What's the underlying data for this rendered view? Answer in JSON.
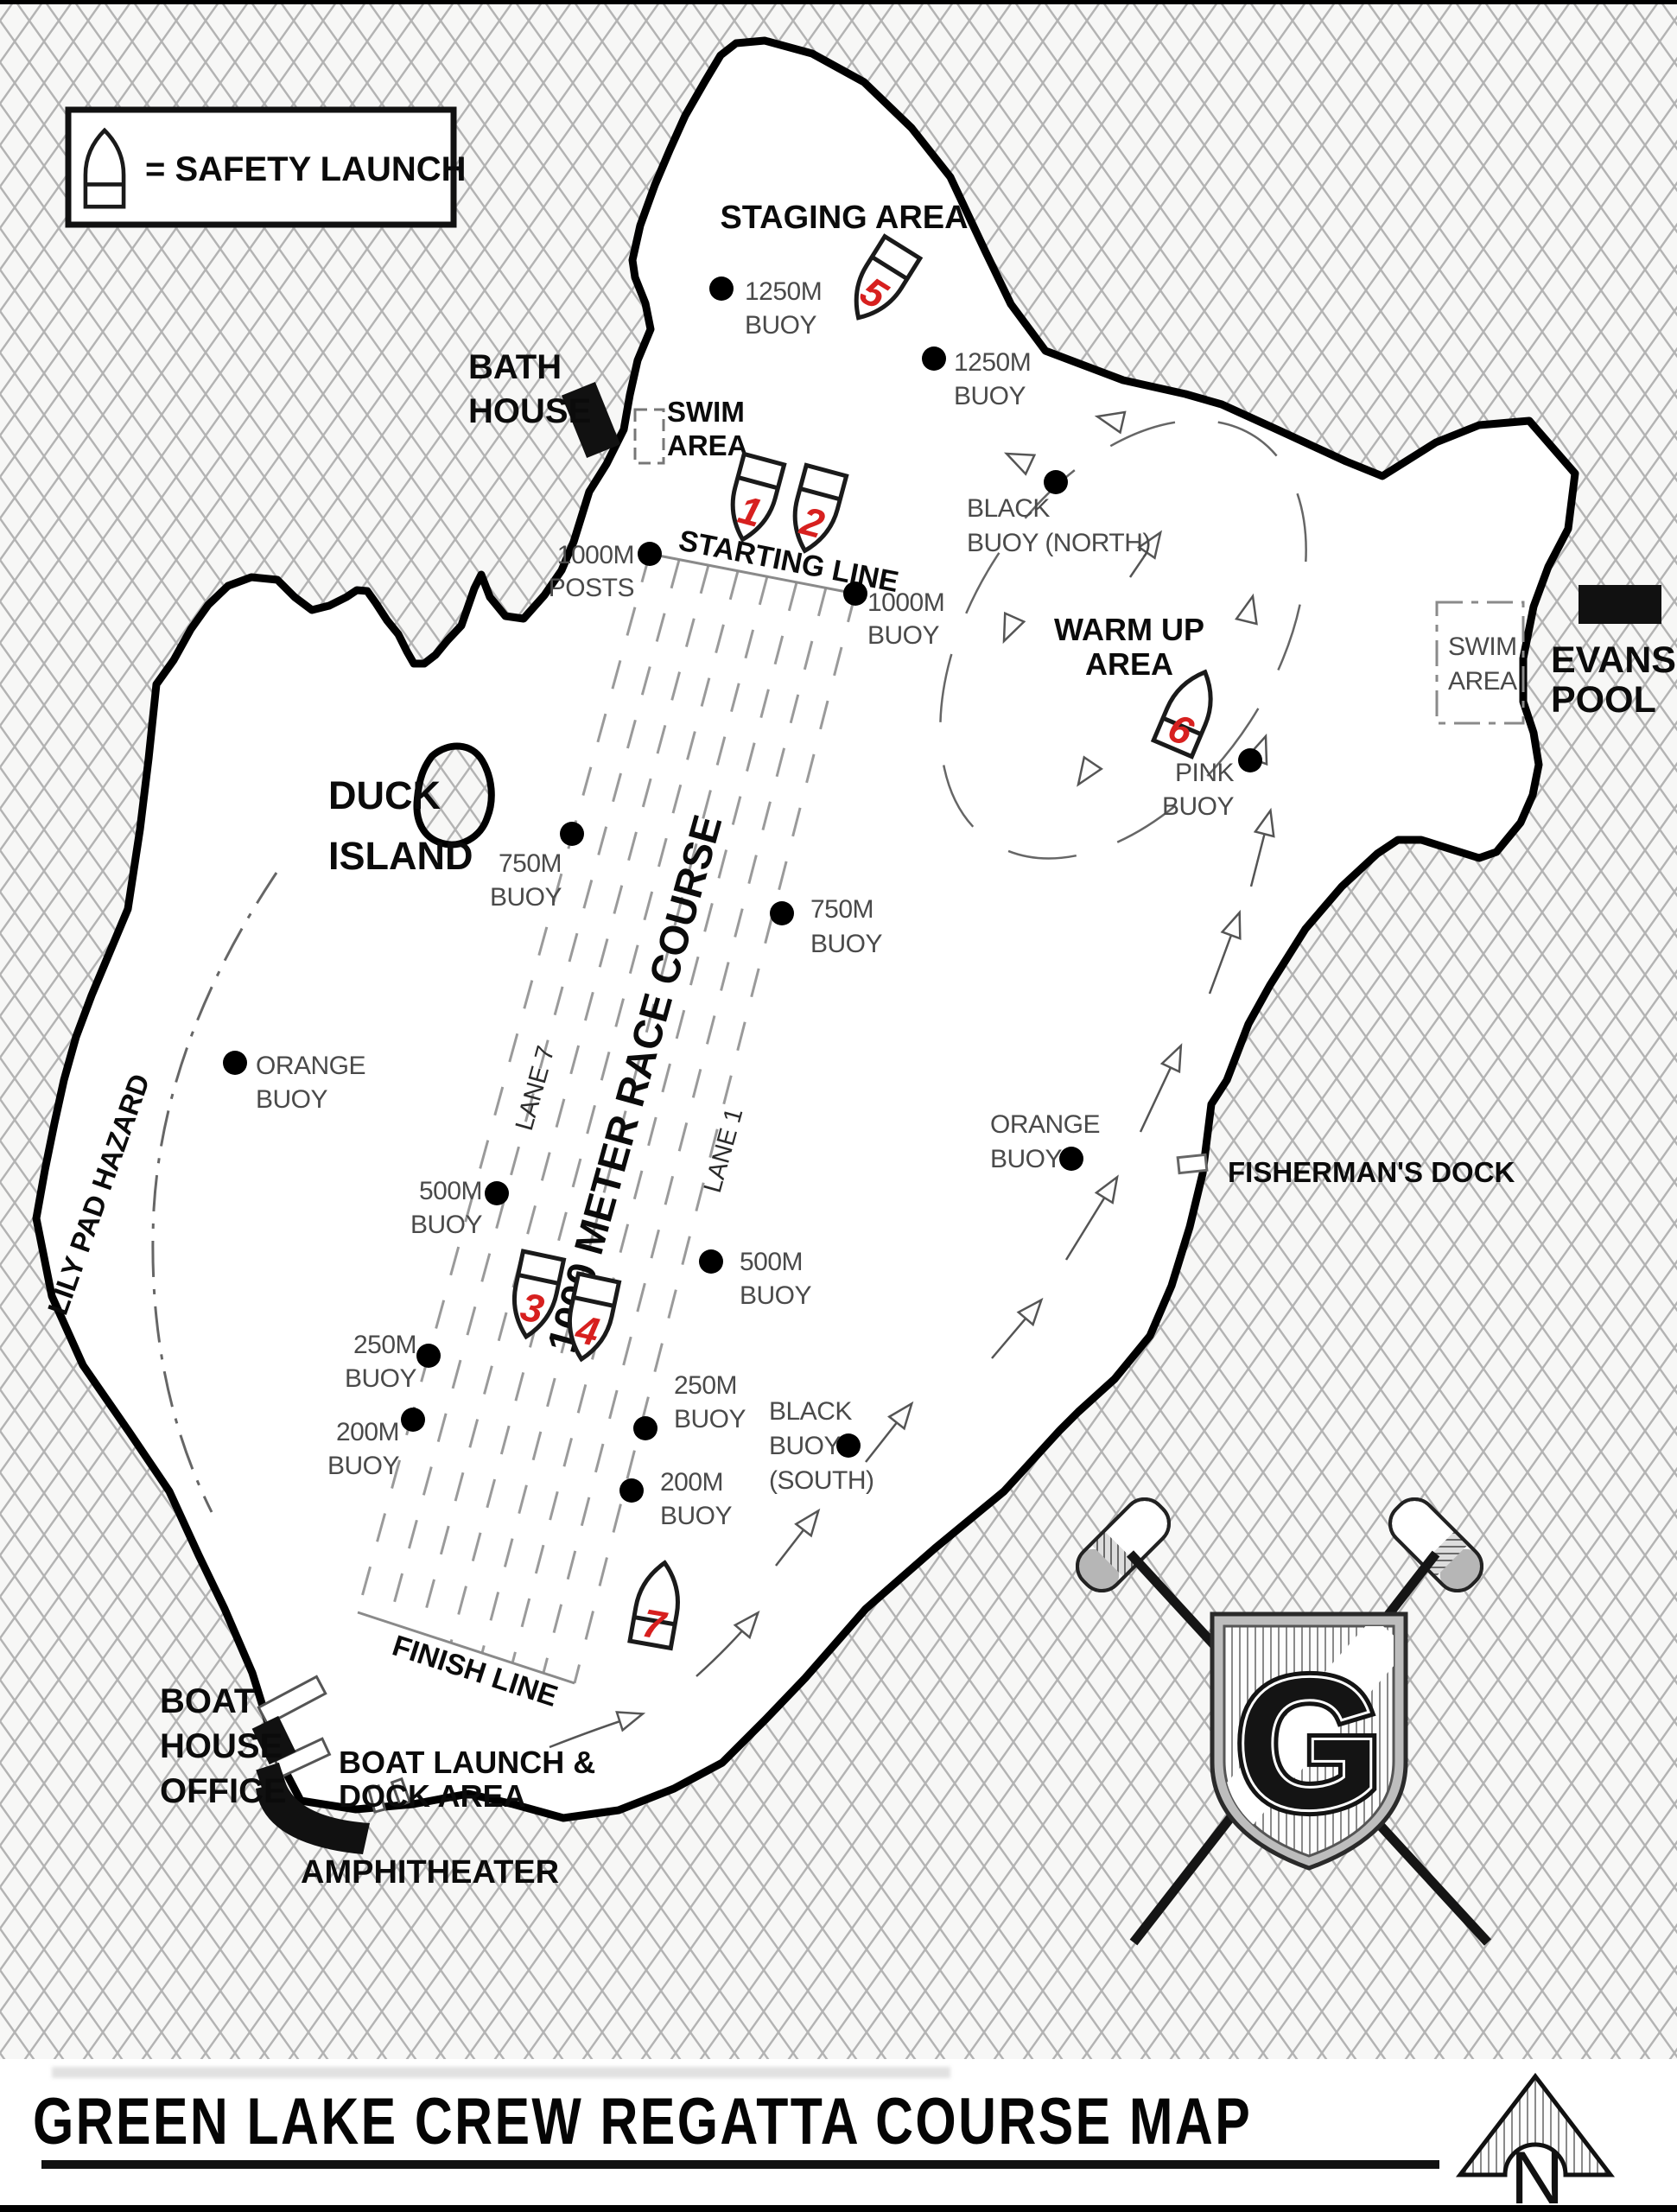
{
  "title": "GREEN LAKE CREW REGATTA COURSE MAP",
  "north_label": "N",
  "legend": {
    "safety_launch": "= SAFETY LAUNCH"
  },
  "colors": {
    "boat_number_red": "#d7201f",
    "land_hatch": "#b3b3b3",
    "buoy_label_gray": "#4a4a4a"
  },
  "areas": {
    "staging": "STAGING AREA",
    "warm_up": [
      "WARM UP",
      "AREA"
    ],
    "bath_house": [
      "BATH",
      "HOUSE"
    ],
    "swim_west": [
      "SWIM",
      "AREA"
    ],
    "swim_east": [
      "SWIM",
      "AREA"
    ],
    "evans_pool": [
      "EVANS",
      "POOL"
    ],
    "duck_island": [
      "DUCK",
      "ISLAND"
    ],
    "fishermans_dock": "FISHERMAN'S DOCK",
    "lily_pad_hazard": "LILY PAD HAZARD",
    "boat_house_office": [
      "BOAT",
      "HOUSE",
      "OFFICE"
    ],
    "boat_launch": [
      "BOAT LAUNCH &",
      "DOCK AREA"
    ],
    "amphitheater": "AMPHITHEATER"
  },
  "course": {
    "name": "1000 METER RACE COURSE",
    "starting_line": "STARTING LINE",
    "finish_line": "FINISH LINE",
    "lane_7": "LANE 7",
    "lane_1": "LANE 1"
  },
  "buoys": {
    "b1250_left": [
      "1250M",
      "BUOY"
    ],
    "b1250_right": [
      "1250M",
      "BUOY"
    ],
    "posts_1000": [
      "1000M",
      "POSTS"
    ],
    "b1000": [
      "1000M",
      "BUOY"
    ],
    "b750_left": [
      "750M",
      "BUOY"
    ],
    "b750_right": [
      "750M",
      "BUOY"
    ],
    "b500_left": [
      "500M",
      "BUOY"
    ],
    "b500_right": [
      "500M",
      "BUOY"
    ],
    "b250_left": [
      "250M",
      "BUOY"
    ],
    "b250_right": [
      "250M",
      "BUOY"
    ],
    "b200_left": [
      "200M",
      "BUOY"
    ],
    "b200_right": [
      "200M",
      "BUOY"
    ],
    "black_north": [
      "BLACK",
      "BUOY (NORTH)"
    ],
    "black_south": [
      "BLACK",
      "BUOY",
      "(SOUTH)"
    ],
    "pink": [
      "PINK",
      "BUOY"
    ],
    "orange_west": [
      "ORANGE",
      "BUOY"
    ],
    "orange_east": [
      "ORANGE",
      "BUOY"
    ]
  },
  "boats": {
    "n1": "1",
    "n2": "2",
    "n3": "3",
    "n4": "4",
    "n5": "5",
    "n6": "6",
    "n7": "7"
  },
  "logo": {
    "letter": "G"
  }
}
